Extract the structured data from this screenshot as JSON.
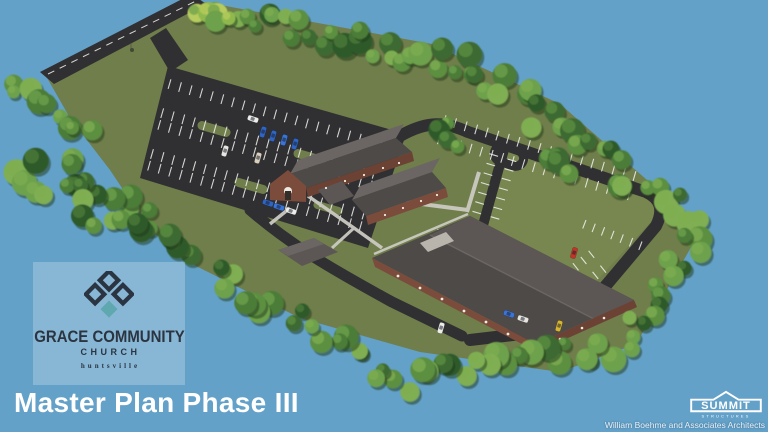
{
  "slide": {
    "title": "Master Plan Phase III"
  },
  "logo_card": {
    "church_name": "GRACE COMMUNITY",
    "church_word": "CHURCH",
    "city": "huntsville"
  },
  "credits": {
    "builder_name": "SUMMIT",
    "builder_tagline": "STRUCTURES",
    "architect_credit": "William Boehme and Associates Architects"
  },
  "colors": {
    "sky": "#63A1C8",
    "grass": "#6F7E4B",
    "field": "#78874F",
    "asphalt": "#302F32",
    "asphalt-light": "#3C3B3F",
    "stripe": "#F2F2EE",
    "roof-dark": "#4E4A48",
    "roof-mid": "#5C5754",
    "roof-light": "#6B6663",
    "brick": "#7B4C3C",
    "brick-dark": "#6B4234",
    "walk": "#CBCAC2",
    "logo-navy": "#2B3441",
    "logo-teal": "#5FA8B0",
    "panel": "rgba(255,255,255,0.24)",
    "title-text": "#FFFFFF",
    "credit-text": "#E9F0F5",
    "tree-1": "#2F5A2B",
    "tree-2": "#3E6B31",
    "tree-3": "#4C7C39",
    "tree-4": "#5C8F41",
    "tree-5": "#6DA14C",
    "tree-6": "#7FAE52"
  }
}
